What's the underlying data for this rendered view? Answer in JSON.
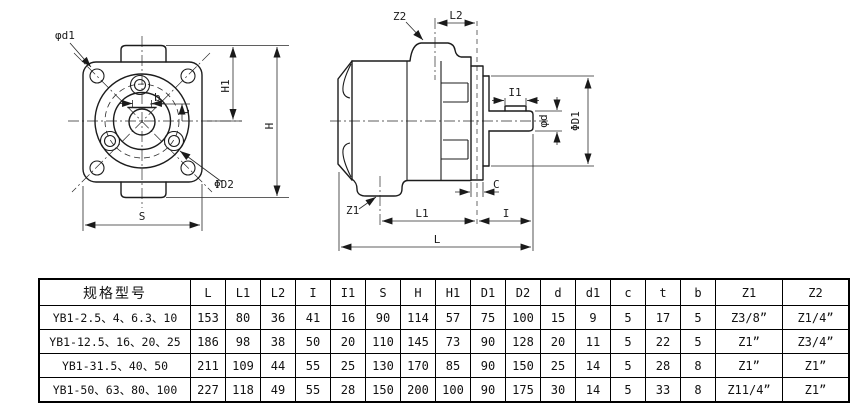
{
  "drawing": {
    "front_view": {
      "labels": {
        "hole_dia": "φd1",
        "key_width": "b",
        "key_depth": "t",
        "half_height": "H1",
        "total_height": "H",
        "flange_width": "S",
        "bolt_circle": "ΦD2"
      }
    },
    "side_view": {
      "labels": {
        "top_port": "Z2",
        "top_port_length": "L2",
        "key_length": "I1",
        "shaft_dia": "φd",
        "spigot_dia": "ΦD1",
        "flange_thickness": "C",
        "bottom_port": "Z1",
        "body_length": "L1",
        "shaft_length": "I",
        "total_length": "L"
      }
    }
  },
  "table": {
    "columns": [
      "规格型号",
      "L",
      "L1",
      "L2",
      "I",
      "I1",
      "S",
      "H",
      "H1",
      "D1",
      "D2",
      "d",
      "d1",
      "c",
      "t",
      "b",
      "Z1",
      "Z2"
    ],
    "rows": [
      [
        "YB1-2.5、4、6.3、10",
        "153",
        "80",
        "36",
        "41",
        "16",
        "90",
        "114",
        "57",
        "75",
        "100",
        "15",
        "9",
        "5",
        "17",
        "5",
        "Z3/8”",
        "Z1/4”"
      ],
      [
        "YB1-12.5、16、20、25",
        "186",
        "98",
        "38",
        "50",
        "20",
        "110",
        "145",
        "73",
        "90",
        "128",
        "20",
        "11",
        "5",
        "22",
        "5",
        "Z1”",
        "Z3/4”"
      ],
      [
        "YB1-31.5、40、50",
        "211",
        "109",
        "44",
        "55",
        "25",
        "130",
        "170",
        "85",
        "90",
        "150",
        "25",
        "14",
        "5",
        "28",
        "8",
        "Z1”",
        "Z1”"
      ],
      [
        "YB1-50、63、80、100",
        "227",
        "118",
        "49",
        "55",
        "28",
        "150",
        "200",
        "100",
        "90",
        "175",
        "30",
        "14",
        "5",
        "33",
        "8",
        "Z11/4”",
        "Z1”"
      ]
    ]
  }
}
